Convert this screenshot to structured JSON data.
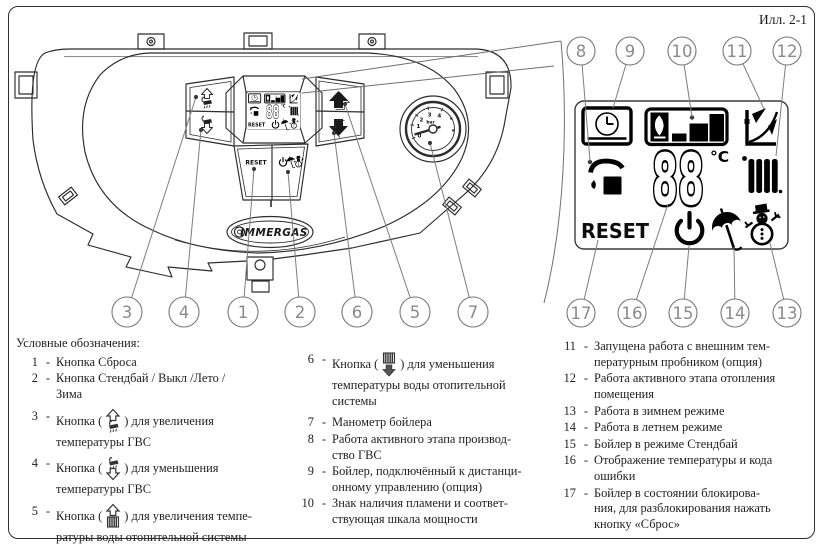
{
  "figure_label": "Илл. 2-1",
  "brand": "IMMERGAS",
  "panel": {
    "reset_label": "RESET",
    "callouts": [
      "3",
      "4",
      "1",
      "2",
      "6",
      "5",
      "7"
    ],
    "gauge": {
      "ticks": [
        "0",
        "1",
        "2",
        "3",
        "4"
      ],
      "unit": "bar"
    }
  },
  "display": {
    "temperature": "88",
    "unit": "°C",
    "reset_label": "RESET",
    "top_callouts": [
      "8",
      "9",
      "10",
      "11",
      "12"
    ],
    "bottom_callouts": [
      "17",
      "16",
      "15",
      "14",
      "13"
    ],
    "symbols": [
      "remote-control-clock",
      "flame-and-power-scale",
      "heating-curve",
      "dhw-shower",
      "radiator",
      "standby-power",
      "summer-umbrella",
      "winter-snowman"
    ]
  },
  "legend": {
    "title": "Условные обозначения:",
    "sep": "-",
    "col1": [
      {
        "num": "1",
        "text": "Кнопка Сброса"
      },
      {
        "num": "2",
        "text": "Кнопка Стендбай / Выкл /Лето /\nЗима"
      },
      {
        "num": "3",
        "pre": "Кнопка (",
        "post": ") для увеличения\nтемпературы ГВС"
      },
      {
        "num": "4",
        "pre": "Кнопка (",
        "post": ") для уменьшения\nтемпературы ГВС"
      },
      {
        "num": "5",
        "pre": "Кнопка (",
        "post": ") для увеличения темпе-\nратуры воды отопительной системы"
      }
    ],
    "col2": [
      {
        "num": "6",
        "pre": "Кнопка (",
        "post": ") для уменьшения\nтемпературы воды отопительной\nсистемы"
      },
      {
        "num": "7",
        "text": "Манометр бойлера"
      },
      {
        "num": "8",
        "text": "Работа активного этапа производ-\nство ГВС"
      },
      {
        "num": "9",
        "text": "Бойлер, подключённый к дистанци-\nонному управлению (опция)"
      },
      {
        "num": "10",
        "text": "Знак наличия пламени и соответ-\nствующая шкала мощности"
      }
    ],
    "col3": [
      {
        "num": "11",
        "text": "Запущена работа с внешним тем-\nпературным пробником (опция)"
      },
      {
        "num": "12",
        "text": "Работа активного этапа отопления\nпомещения"
      },
      {
        "num": "13",
        "text": "Работа в зимнем режиме"
      },
      {
        "num": "14",
        "text": "Работа в летнем режиме"
      },
      {
        "num": "15",
        "text": "Бойлер в режиме Стендбай"
      },
      {
        "num": "16",
        "text": "Отображение температуры и кода\nошибки"
      },
      {
        "num": "17",
        "text": "Бойлер в состоянии блокирова-\nния, для разблокирования нажать\nкнопку «Сброс»"
      }
    ]
  }
}
